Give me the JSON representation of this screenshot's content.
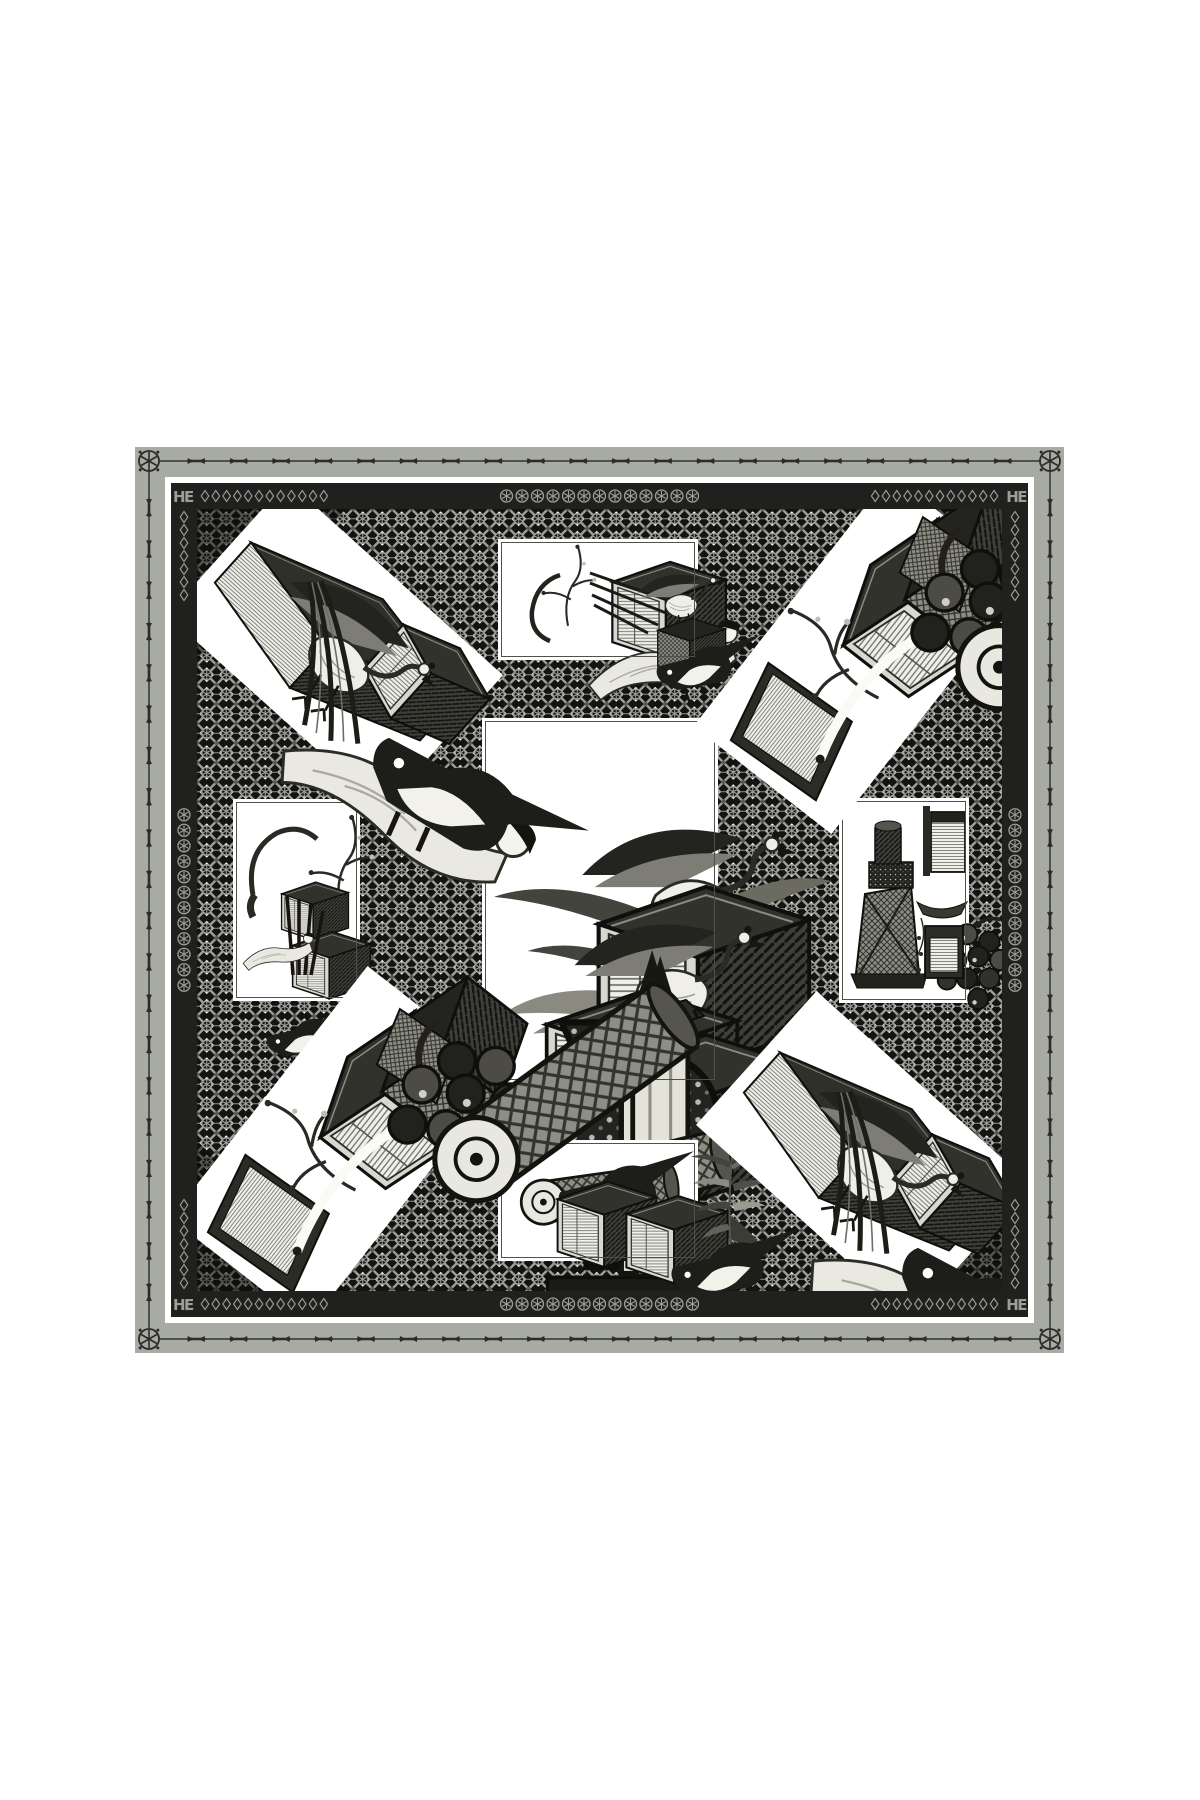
{
  "image": {
    "background": "#ffffff",
    "subject": "black-and-white silk scarf, chinoiserie lacquer cabinets, cranes and bamboo on a geometric lattice ground"
  },
  "scarf": {
    "colors": {
      "outer_band": "#a8aba3",
      "border_line": "#2b2b29",
      "black_band": "#20201e",
      "ornament_gray": "#9c9f98",
      "lattice_bg": "#131311",
      "lattice_gray": "#9c9f98",
      "paper": "#ffffff",
      "ink": "#14140f"
    },
    "outer_border": {
      "corner_rosettes": 4,
      "dash_motifs_per_side": 20
    },
    "black_band": {
      "monogram": "HE",
      "rosette_chain_top_count": 13,
      "rosette_chain_bottom_count": 13,
      "rosette_chain_side_count": 12,
      "diamond_chain_horizontal_count": 12,
      "diamond_chain_vertical_count": 7
    },
    "panels": [
      {
        "id": "center",
        "motif": "bamboo-cranes-cabinet-stack",
        "x": 285,
        "y": 209,
        "w": 236,
        "h": 365,
        "rot": 0,
        "framed": true
      },
      {
        "id": "top-center",
        "motif": "peacock-open-cabinet-figure",
        "x": 301,
        "y": 30,
        "w": 200,
        "h": 121,
        "rot": 0,
        "framed": true
      },
      {
        "id": "bottom-center",
        "motif": "cabinets-birds-bamboo",
        "x": 301,
        "y": 631,
        "w": 200,
        "h": 121,
        "rot": 0,
        "framed": true
      },
      {
        "id": "left-middle",
        "motif": "peacock-cabinets-brushes",
        "x": 36,
        "y": 290,
        "w": 127,
        "h": 202,
        "rot": 0,
        "framed": true
      },
      {
        "id": "right-middle",
        "motif": "vase-stand-cabinets",
        "x": 642,
        "y": 289,
        "w": 130,
        "h": 205,
        "rot": 0,
        "framed": true
      },
      {
        "id": "top-left",
        "motif": "peacock-figure-cabinets",
        "cx": 138,
        "cy": 136,
        "w": 290,
        "h": 180,
        "rot": 42,
        "framed": false
      },
      {
        "id": "top-right",
        "motif": "cabinet-strip-grapes-scroll",
        "cx": 664,
        "cy": 145,
        "w": 320,
        "h": 175,
        "rot": -52,
        "framed": false
      },
      {
        "id": "bottom-left",
        "motif": "cabinet-strip-grapes-scroll",
        "cx": 141,
        "cy": 637,
        "w": 320,
        "h": 175,
        "rot": -52,
        "framed": false
      },
      {
        "id": "bottom-right",
        "motif": "peacock-figure-cabinets",
        "cx": 667,
        "cy": 646,
        "w": 290,
        "h": 180,
        "rot": 42,
        "framed": false
      }
    ]
  }
}
